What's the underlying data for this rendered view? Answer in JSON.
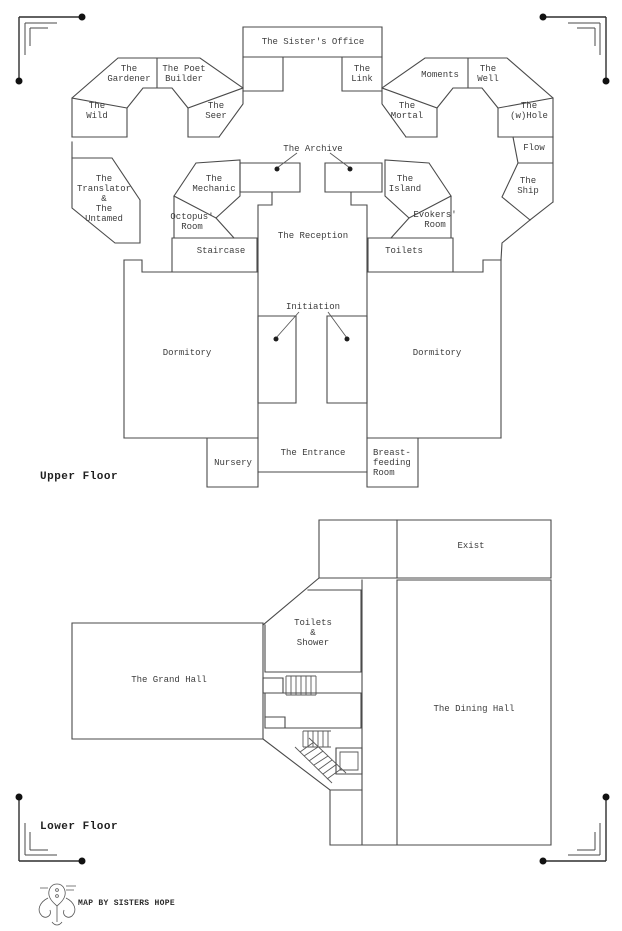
{
  "map_title": {
    "upper_floor": "Upper Floor",
    "lower_floor": "Lower Floor",
    "credit": "MAP BY SISTERS HOPE"
  },
  "upper_rooms": {
    "sisters_office": "The Sister's Office",
    "the_link": "The\nLink",
    "the_gardener": "The\nGardener",
    "the_poet_builder": "The Poet\nBuilder",
    "the_wild": "The\nWild",
    "the_seer": "The\nSeer",
    "moments": "Moments",
    "the_well": "The\nWell",
    "the_mortal": "The\nMortal",
    "the_whole": "The\n(w)Hole",
    "flow": "Flow",
    "the_ship": "The\nShip",
    "translator_untamed": "The\nTranslator\n&\nThe\nUntamed",
    "the_mechanic": "The\nMechanic",
    "octopus_room": "Octopus'\nRoom",
    "staircase": "Staircase",
    "the_archive": "The Archive",
    "the_island": "The\nIsland",
    "evokers_room": "Evokers'\nRoom",
    "toilets": "Toilets",
    "the_reception": "The Reception",
    "initiation": "Initiation",
    "dormitory_left": "Dormitory",
    "dormitory_right": "Dormitory",
    "nursery": "Nursery",
    "the_entrance": "The Entrance",
    "breastfeeding_room": "Breast-\nfeeding\nRoom"
  },
  "lower_rooms": {
    "exist": "Exist",
    "toilets_shower": "Toilets\n&\nShower",
    "grand_hall": "The Grand Hall",
    "dining_hall": "The Dining Hall"
  }
}
